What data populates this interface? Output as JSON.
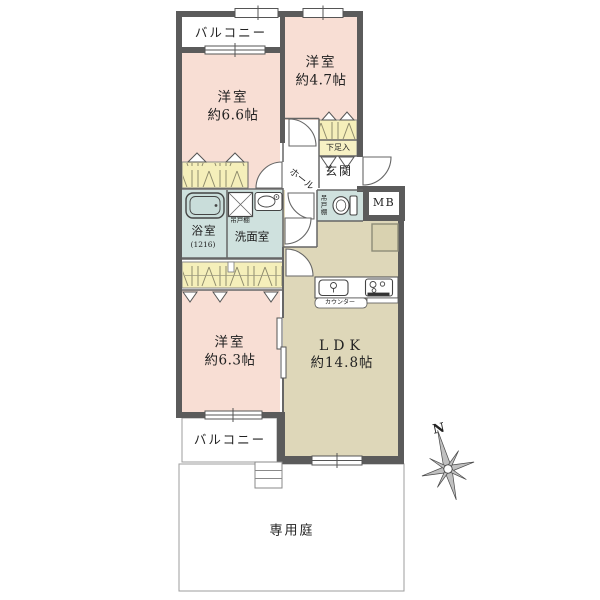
{
  "plan": {
    "balcony_top": {
      "label": "バルコニー"
    },
    "bedroom_66": {
      "name": "洋室",
      "size": "約6.6帖"
    },
    "bedroom_47": {
      "name": "洋室",
      "size": "約4.7帖"
    },
    "bedroom_63": {
      "name": "洋室",
      "size": "約6.3帖"
    },
    "ldk": {
      "name": "LDK",
      "size": "約14.8帖"
    },
    "entrance": {
      "label": "玄関"
    },
    "hall": {
      "label": "ホール"
    },
    "shoe_storage": {
      "label": "下足入"
    },
    "bathroom": {
      "label": "浴室",
      "size": "(1216)"
    },
    "washroom": {
      "label": "洗面室"
    },
    "washroom_hanging_cabinet": {
      "label": "吊戸棚"
    },
    "toilet_hanging_cabinet": {
      "label": "吊戸棚"
    },
    "meter_box": {
      "label": "MB"
    },
    "kitchen_counter": {
      "label": "カウンター"
    },
    "balcony_bottom": {
      "label": "バルコニー"
    },
    "private_garden": {
      "label": "専用庭"
    },
    "compass": {
      "north": "N"
    }
  },
  "colors": {
    "wall": "#5b5b5b",
    "bedroom_pink": "#f8ded4",
    "ldk_tan": "#ded7b9",
    "wet_area_blue": "#cfe1de",
    "closet_yellow": "#f5efba",
    "outline": "#666666"
  }
}
